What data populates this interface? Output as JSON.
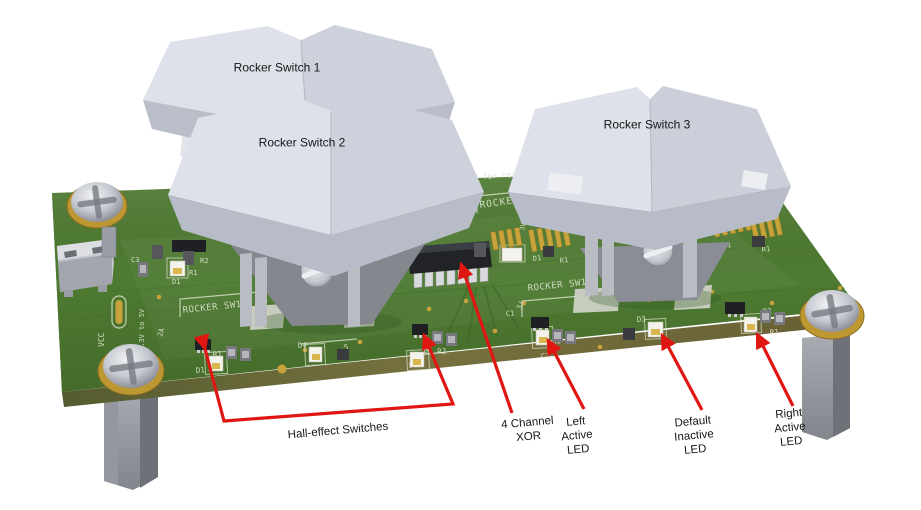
{
  "annotations": {
    "rocker_switch_1": "Rocker Switch 1",
    "rocker_switch_2": "Rocker Switch 2",
    "rocker_switch_3": "Rocker Switch 3",
    "hall_effect_switches": "Hall-effect Switches",
    "four_channel_xor": "4 Channel\nXOR",
    "left_active_led": "Left\nActive\nLED",
    "default_inactive_led": "Default\nInactive\nLED",
    "right_active_led": "Right\nActive\nLED"
  },
  "silkscreen": [
    {
      "t": "C approved for resa"
    },
    {
      "t": "ROCKER S"
    },
    {
      "t": "ROCKER SW1"
    },
    {
      "t": "ROCKER SW1"
    },
    {
      "t": "VCC"
    },
    {
      "t": "3.3V to 5V"
    },
    {
      "t": "R2"
    },
    {
      "t": "R1"
    },
    {
      "t": "D1"
    },
    {
      "t": "C3"
    },
    {
      "t": "2A"
    },
    {
      "t": "R1 R2"
    },
    {
      "t": "D1"
    },
    {
      "t": "D4"
    },
    {
      "t": "5"
    },
    {
      "t": "R1 R2"
    },
    {
      "t": "D1"
    },
    {
      "t": "C1"
    },
    {
      "t": "3/"
    },
    {
      "t": "R1 R2"
    },
    {
      "t": "C1"
    },
    {
      "t": "D3"
    },
    {
      "t": "R2"
    },
    {
      "t": "R1"
    },
    {
      "t": "D1"
    },
    {
      "t": "R1"
    },
    {
      "t": "D1"
    },
    {
      "t": "R1"
    },
    {
      "t": "3V0"
    },
    {
      "t": "3A0"
    }
  ],
  "colors": {
    "background": "#ffffff",
    "board_green": "#4e7a31",
    "board_edge_olive": "#6f7040",
    "annotation_red": "#e01613",
    "switch_cap_gray": "#dee1e9",
    "pad_gold": "#c8a33c",
    "silkscreen_white": "#dce3cd",
    "label_text": "#161616"
  }
}
